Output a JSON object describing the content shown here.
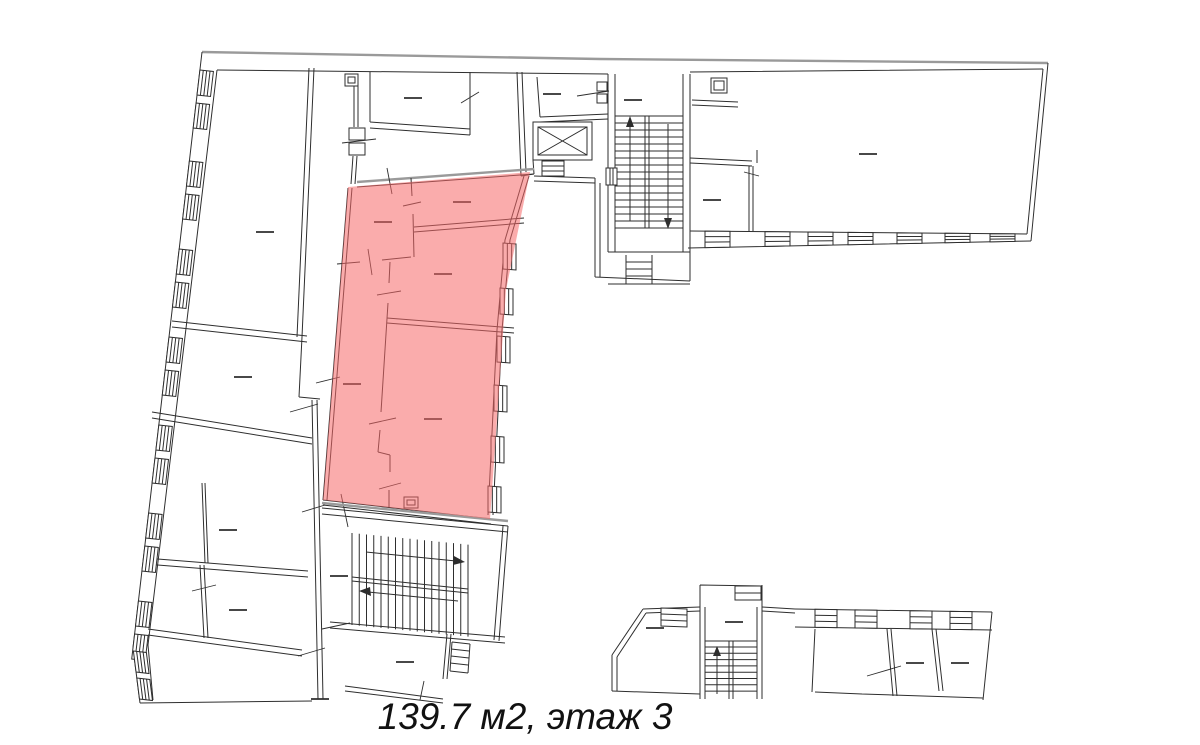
{
  "caption": {
    "text": "139.7 м2, этаж 3",
    "area": "139.7 м2",
    "floor": "этаж 3"
  },
  "plan": {
    "background_color": "#ffffff",
    "line_color": "#2e2e2e",
    "outer_wall_color": "#9a9a9a",
    "highlight": {
      "name": "selected-unit",
      "color": "#f56868",
      "opacity": "0.55"
    },
    "symbols": [
      {
        "name": "elevator-icon",
        "glyph": "crossed-box"
      },
      {
        "name": "up-arrow-icon",
        "glyph": "↑"
      },
      {
        "name": "down-arrow-icon",
        "glyph": "↓"
      },
      {
        "name": "right-arrow-icon",
        "glyph": "→"
      },
      {
        "name": "left-arrow-icon",
        "glyph": "←"
      },
      {
        "name": "window-hatch-icon",
        "glyph": "parallel-lines"
      },
      {
        "name": "door-tick-icon",
        "glyph": "slash"
      },
      {
        "name": "room-label-dash-icon",
        "glyph": "—"
      }
    ]
  }
}
